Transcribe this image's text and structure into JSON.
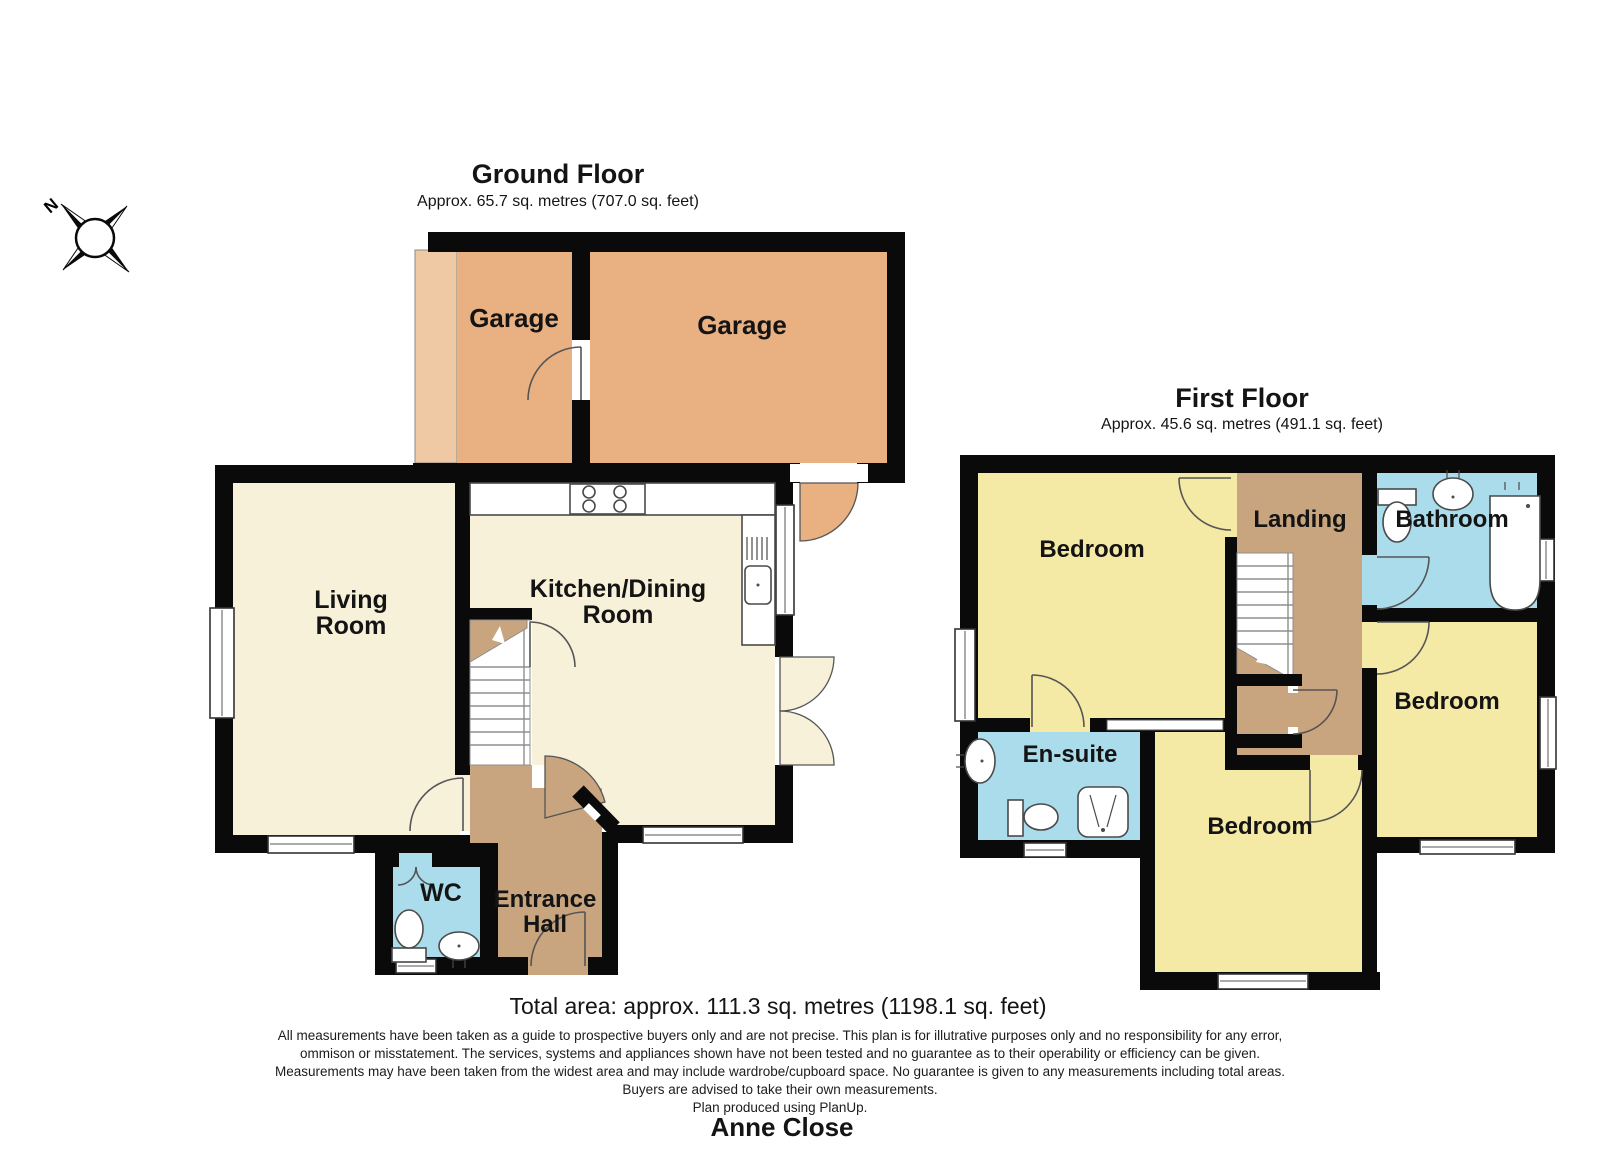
{
  "compass": {
    "label": "N"
  },
  "ground_floor": {
    "title": "Ground Floor",
    "subtitle": "Approx. 65.7 sq. metres (707.0 sq. feet)",
    "rooms": {
      "garage_left": "Garage",
      "garage_right": "Garage",
      "living_line1": "Living",
      "living_line2": "Room",
      "kitchen_line1": "Kitchen/Dining",
      "kitchen_line2": "Room",
      "wc": "WC",
      "hall_line1": "Entrance",
      "hall_line2": "Hall"
    }
  },
  "first_floor": {
    "title": "First Floor",
    "subtitle": "Approx. 45.6 sq. metres (491.1 sq. feet)",
    "rooms": {
      "bedroom_top_left": "Bedroom",
      "landing": "Landing",
      "bathroom": "Bathroom",
      "ensuite": "En-suite",
      "bedroom_bottom": "Bedroom",
      "bedroom_right": "Bedroom"
    }
  },
  "footer": {
    "total_area": "Total area: approx. 111.3 sq. metres (1198.1 sq. feet)",
    "disclaimer_lines": [
      "All measurements have been taken as a guide to prospective buyers only and are not precise. This plan is for illutrative purposes only and no responsibility for any error,",
      "ommison or misstatement. The services, systems and appliances shown have not been tested and no guarantee as to their operability or efficiency can be given.",
      "Measurements may have been taken from the widest area and may include wardrobe/cupboard space. No guarantee is given to any measurements including total areas.",
      "Buyers are advised to take their own measurements."
    ],
    "credit": "Plan produced using PlanUp.",
    "property_name": "Anne Close"
  },
  "colors": {
    "wall": "#0a0a0a",
    "cream": "#f8f1da",
    "tan": "#c9a57f",
    "orange": "#e9b082",
    "orangelight": "#efc9a3",
    "yellow": "#f5e9a6",
    "blue": "#aadceb",
    "line": "#555555"
  }
}
